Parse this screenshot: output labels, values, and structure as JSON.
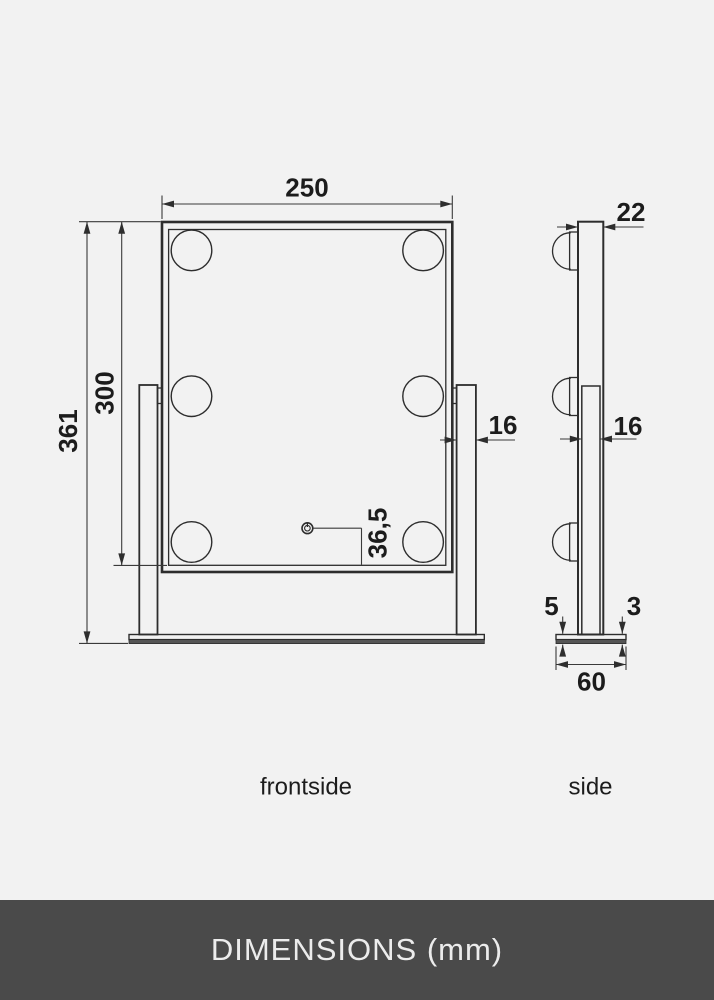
{
  "views": {
    "front": {
      "caption": "frontside",
      "width_mm": "250",
      "total_height_mm": "361",
      "mirror_height_mm": "300",
      "arm_width_mm": "16",
      "button_to_edge_mm": "36,5"
    },
    "side": {
      "caption": "side",
      "mirror_thickness_mm": "22",
      "arm_thickness_mm": "16",
      "base_top_thickness_mm": "5",
      "base_plate_thickness_mm": "3",
      "base_depth_mm": "60"
    }
  },
  "footer": {
    "title": "DIMENSIONS (mm)"
  },
  "colors": {
    "background": "#f2f2f2",
    "line": "#2d2d2d",
    "dimension_line": "#3a3a3a",
    "text": "#1c1c1c",
    "base_plate_fill": "#555555",
    "footer_background": "#4a4a4a",
    "footer_text": "#ececec"
  }
}
